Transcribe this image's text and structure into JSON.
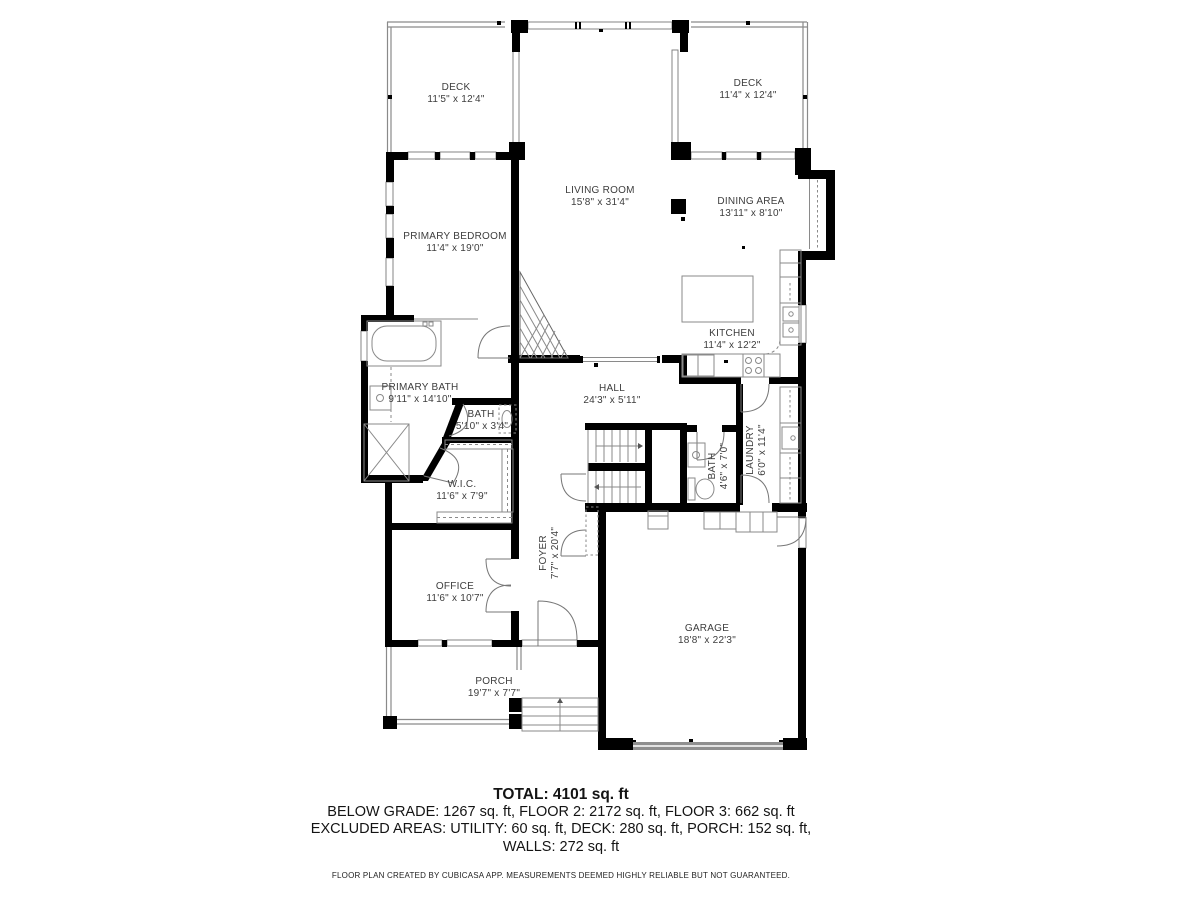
{
  "plan": {
    "rooms": [
      {
        "id": "deck-left",
        "name": "DECK",
        "dims": "11'5\" x 12'4\""
      },
      {
        "id": "deck-right",
        "name": "DECK",
        "dims": "11'4\" x 12'4\""
      },
      {
        "id": "living-room",
        "name": "LIVING ROOM",
        "dims": "15'8\" x 31'4\""
      },
      {
        "id": "dining-area",
        "name": "DINING AREA",
        "dims": "13'11\" x 8'10\""
      },
      {
        "id": "primary-bedroom",
        "name": "PRIMARY BEDROOM",
        "dims": "11'4\" x 19'0\""
      },
      {
        "id": "kitchen",
        "name": "KITCHEN",
        "dims": "11'4\" x 12'2\""
      },
      {
        "id": "primary-bath",
        "name": "PRIMARY BATH",
        "dims": "9'11\" x 14'10\""
      },
      {
        "id": "bath-upper",
        "name": "BATH",
        "dims": "5'10\" x 3'4\""
      },
      {
        "id": "hall",
        "name": "HALL",
        "dims": "24'3\" x 5'11\""
      },
      {
        "id": "wic",
        "name": "W.I.C.",
        "dims": "11'6\" x 7'9\""
      },
      {
        "id": "bath-lower",
        "name": "BATH",
        "dims": "4'6\" x 7'0\""
      },
      {
        "id": "laundry",
        "name": "LAUNDRY",
        "dims": "6'0\" x 11'4\""
      },
      {
        "id": "foyer",
        "name": "FOYER",
        "dims": "7'7\" x 20'4\""
      },
      {
        "id": "office",
        "name": "OFFICE",
        "dims": "11'6\" x 10'7\""
      },
      {
        "id": "garage",
        "name": "GARAGE",
        "dims": "18'8\" x 22'3\""
      },
      {
        "id": "porch",
        "name": "PORCH",
        "dims": "19'7\" x 7'7\""
      }
    ]
  },
  "summary": {
    "total": "TOTAL: 4101 sq. ft",
    "line1": "BELOW GRADE: 1267 sq. ft, FLOOR 2: 2172 sq. ft, FLOOR 3: 662 sq. ft",
    "line2": "EXCLUDED AREAS: UTILITY: 60 sq. ft, DECK: 280 sq. ft, PORCH: 152 sq. ft,",
    "line3": "WALLS: 272 sq. ft"
  },
  "footer": {
    "disclaimer": "FLOOR PLAN CREATED BY CUBICASA APP. MEASUREMENTS DEEMED HIGHLY RELIABLE BUT NOT GUARANTEED."
  },
  "colors": {
    "wall": "#000000",
    "line": "#8a8a8a",
    "label": "#3d3d3d",
    "background": "#ffffff"
  }
}
